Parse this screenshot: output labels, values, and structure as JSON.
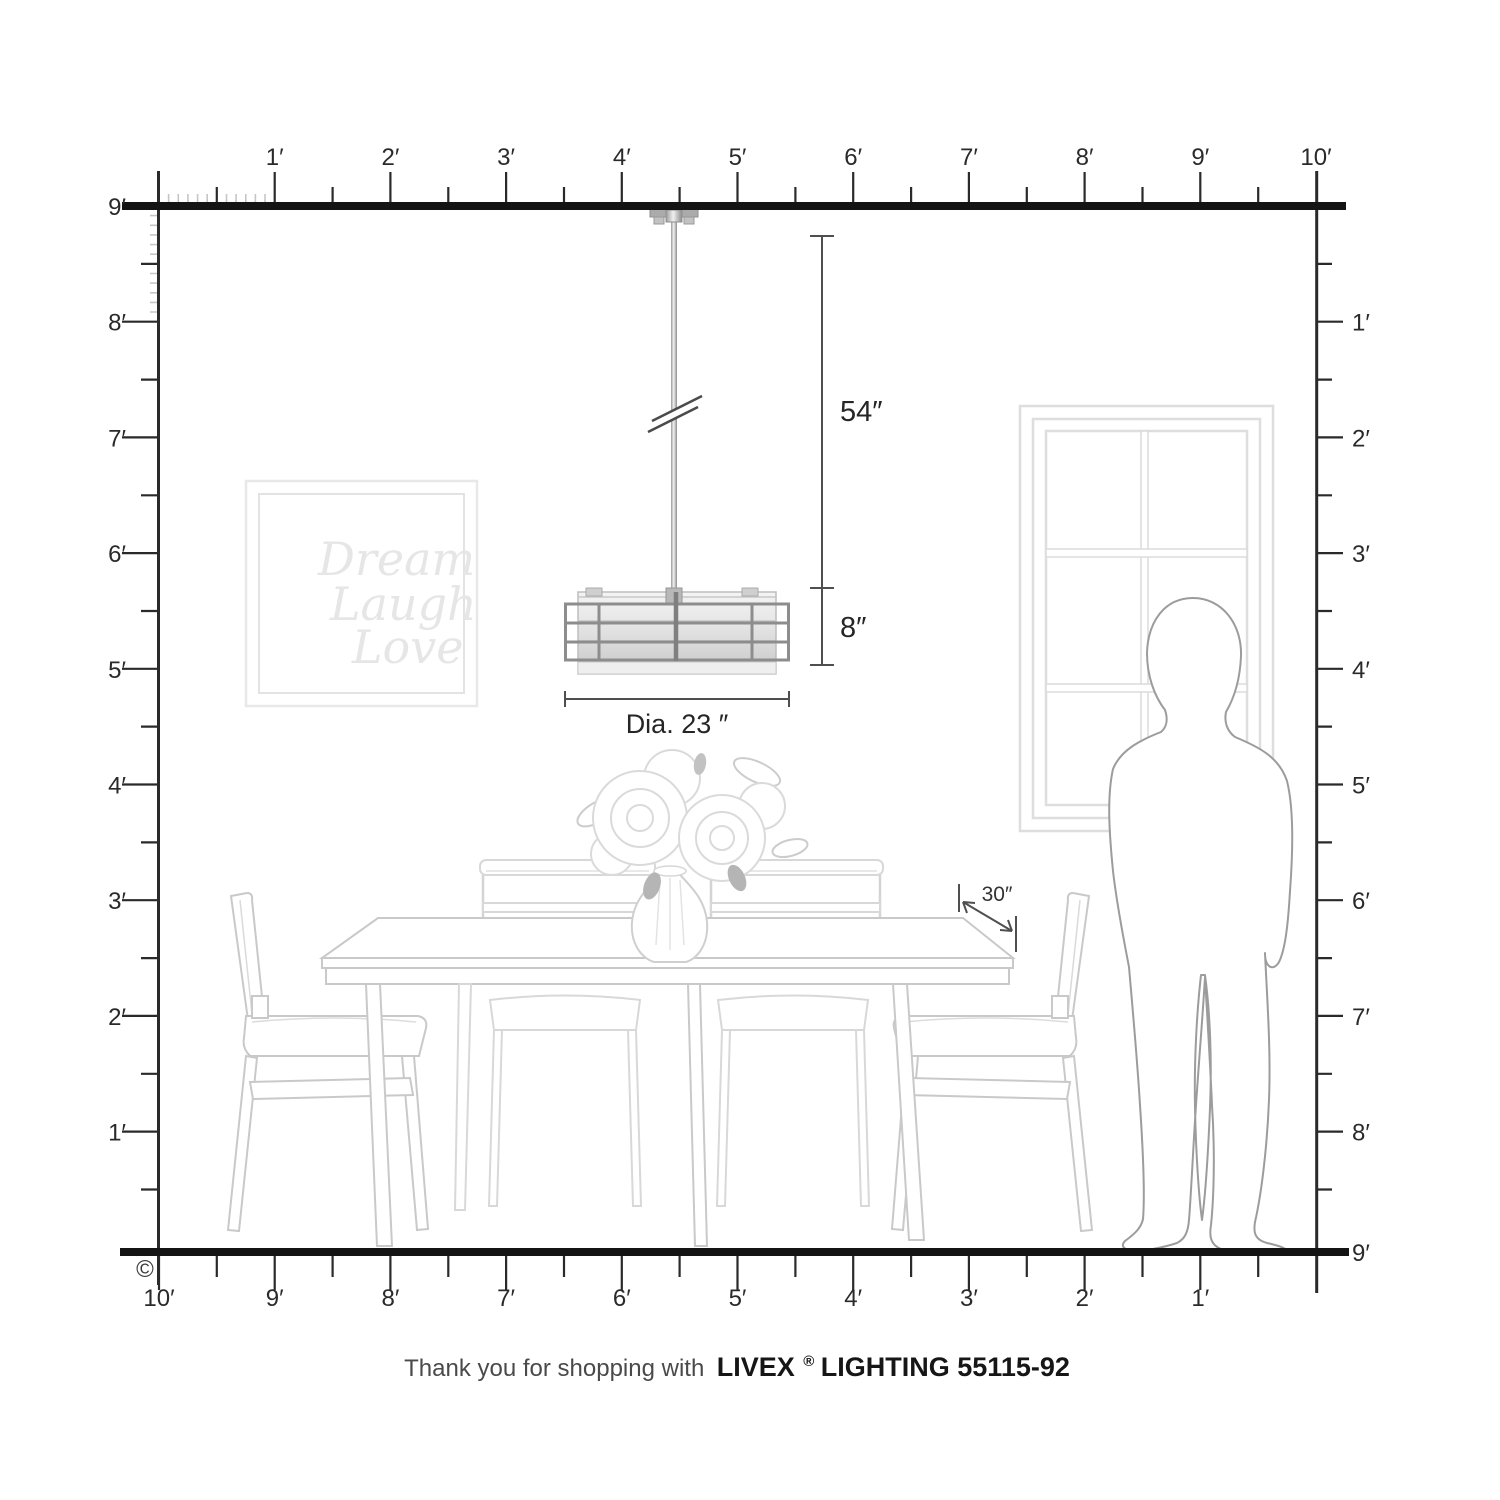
{
  "rulers": {
    "top": [
      "1′",
      "2′",
      "3′",
      "4′",
      "5′",
      "6′",
      "7′",
      "8′",
      "9′",
      "10′"
    ],
    "bottom": [
      "10′",
      "9′",
      "8′",
      "7′",
      "6′",
      "5′",
      "4′",
      "3′",
      "2′",
      "1′"
    ],
    "left": [
      "9′",
      "8′",
      "7′",
      "6′",
      "5′",
      "4′",
      "3′",
      "2′",
      "1′"
    ],
    "right": [
      "1′",
      "2′",
      "3′",
      "4′",
      "5′",
      "6′",
      "7′",
      "8′",
      "9′"
    ]
  },
  "annotations": {
    "drop_length": "54″",
    "shade_height": "8″",
    "diameter": "Dia. 23 ″",
    "table_depth": "30″"
  },
  "wall_art": {
    "lines": [
      "Dream",
      "Laugh",
      "Love"
    ]
  },
  "footer": {
    "prefix": "Thank you for shopping with",
    "brand": "LIVEX",
    "registered": "®",
    "suffix": "LIGHTING 55115-92"
  },
  "copyright": "©",
  "colors": {
    "ruler": "#2a2a2a",
    "structure_line": "#141414",
    "dimension": "#4f4f4f",
    "furniture_line": "#c9c9c9",
    "person_line": "#9c9c9c",
    "window_line": "#dedede",
    "art_line": "#e6e6e6",
    "cage_metal": "#8d8d8d"
  }
}
